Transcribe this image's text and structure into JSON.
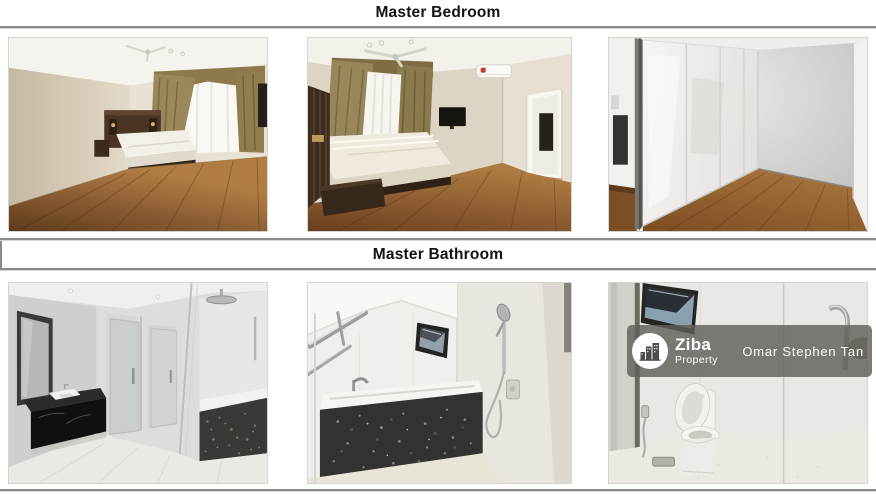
{
  "sections": [
    {
      "title": "Master Bedroom",
      "photos": [
        {
          "label": "Bedroom with dark wooden floor, bed with dark headboard and gold curtains over a bright window"
        },
        {
          "label": "Bedroom with ceiling fan, gold curtains, wall-mounted TV, air conditioner and open doorway to hallway"
        },
        {
          "label": "Walk-in wardrobe with glossy white panels, grey wall and wooden floor"
        }
      ]
    },
    {
      "title": "Master Bathroom",
      "photos": [
        {
          "label": "Bathroom with black marble vanity and mirror, glass shower partitions and bathtub with dark stone panel"
        },
        {
          "label": "Bathtub with dark terrazzo front panel, chrome towel bars, hand shower and small window"
        },
        {
          "label": "Toilet with open lid, window with blue sky, bidet sprayer and glass shower screen"
        }
      ]
    }
  ],
  "watermark": {
    "brand": "Ziba",
    "brand_sub": "Property",
    "agent": "Omar Stephen Tan",
    "logo_icon": "buildings-skyline-icon"
  },
  "colors": {
    "divider": "#8a8a8a",
    "title_text": "#121212",
    "watermark_band": "rgba(97,95,89,0.82)",
    "watermark_text": "#ffffff"
  }
}
